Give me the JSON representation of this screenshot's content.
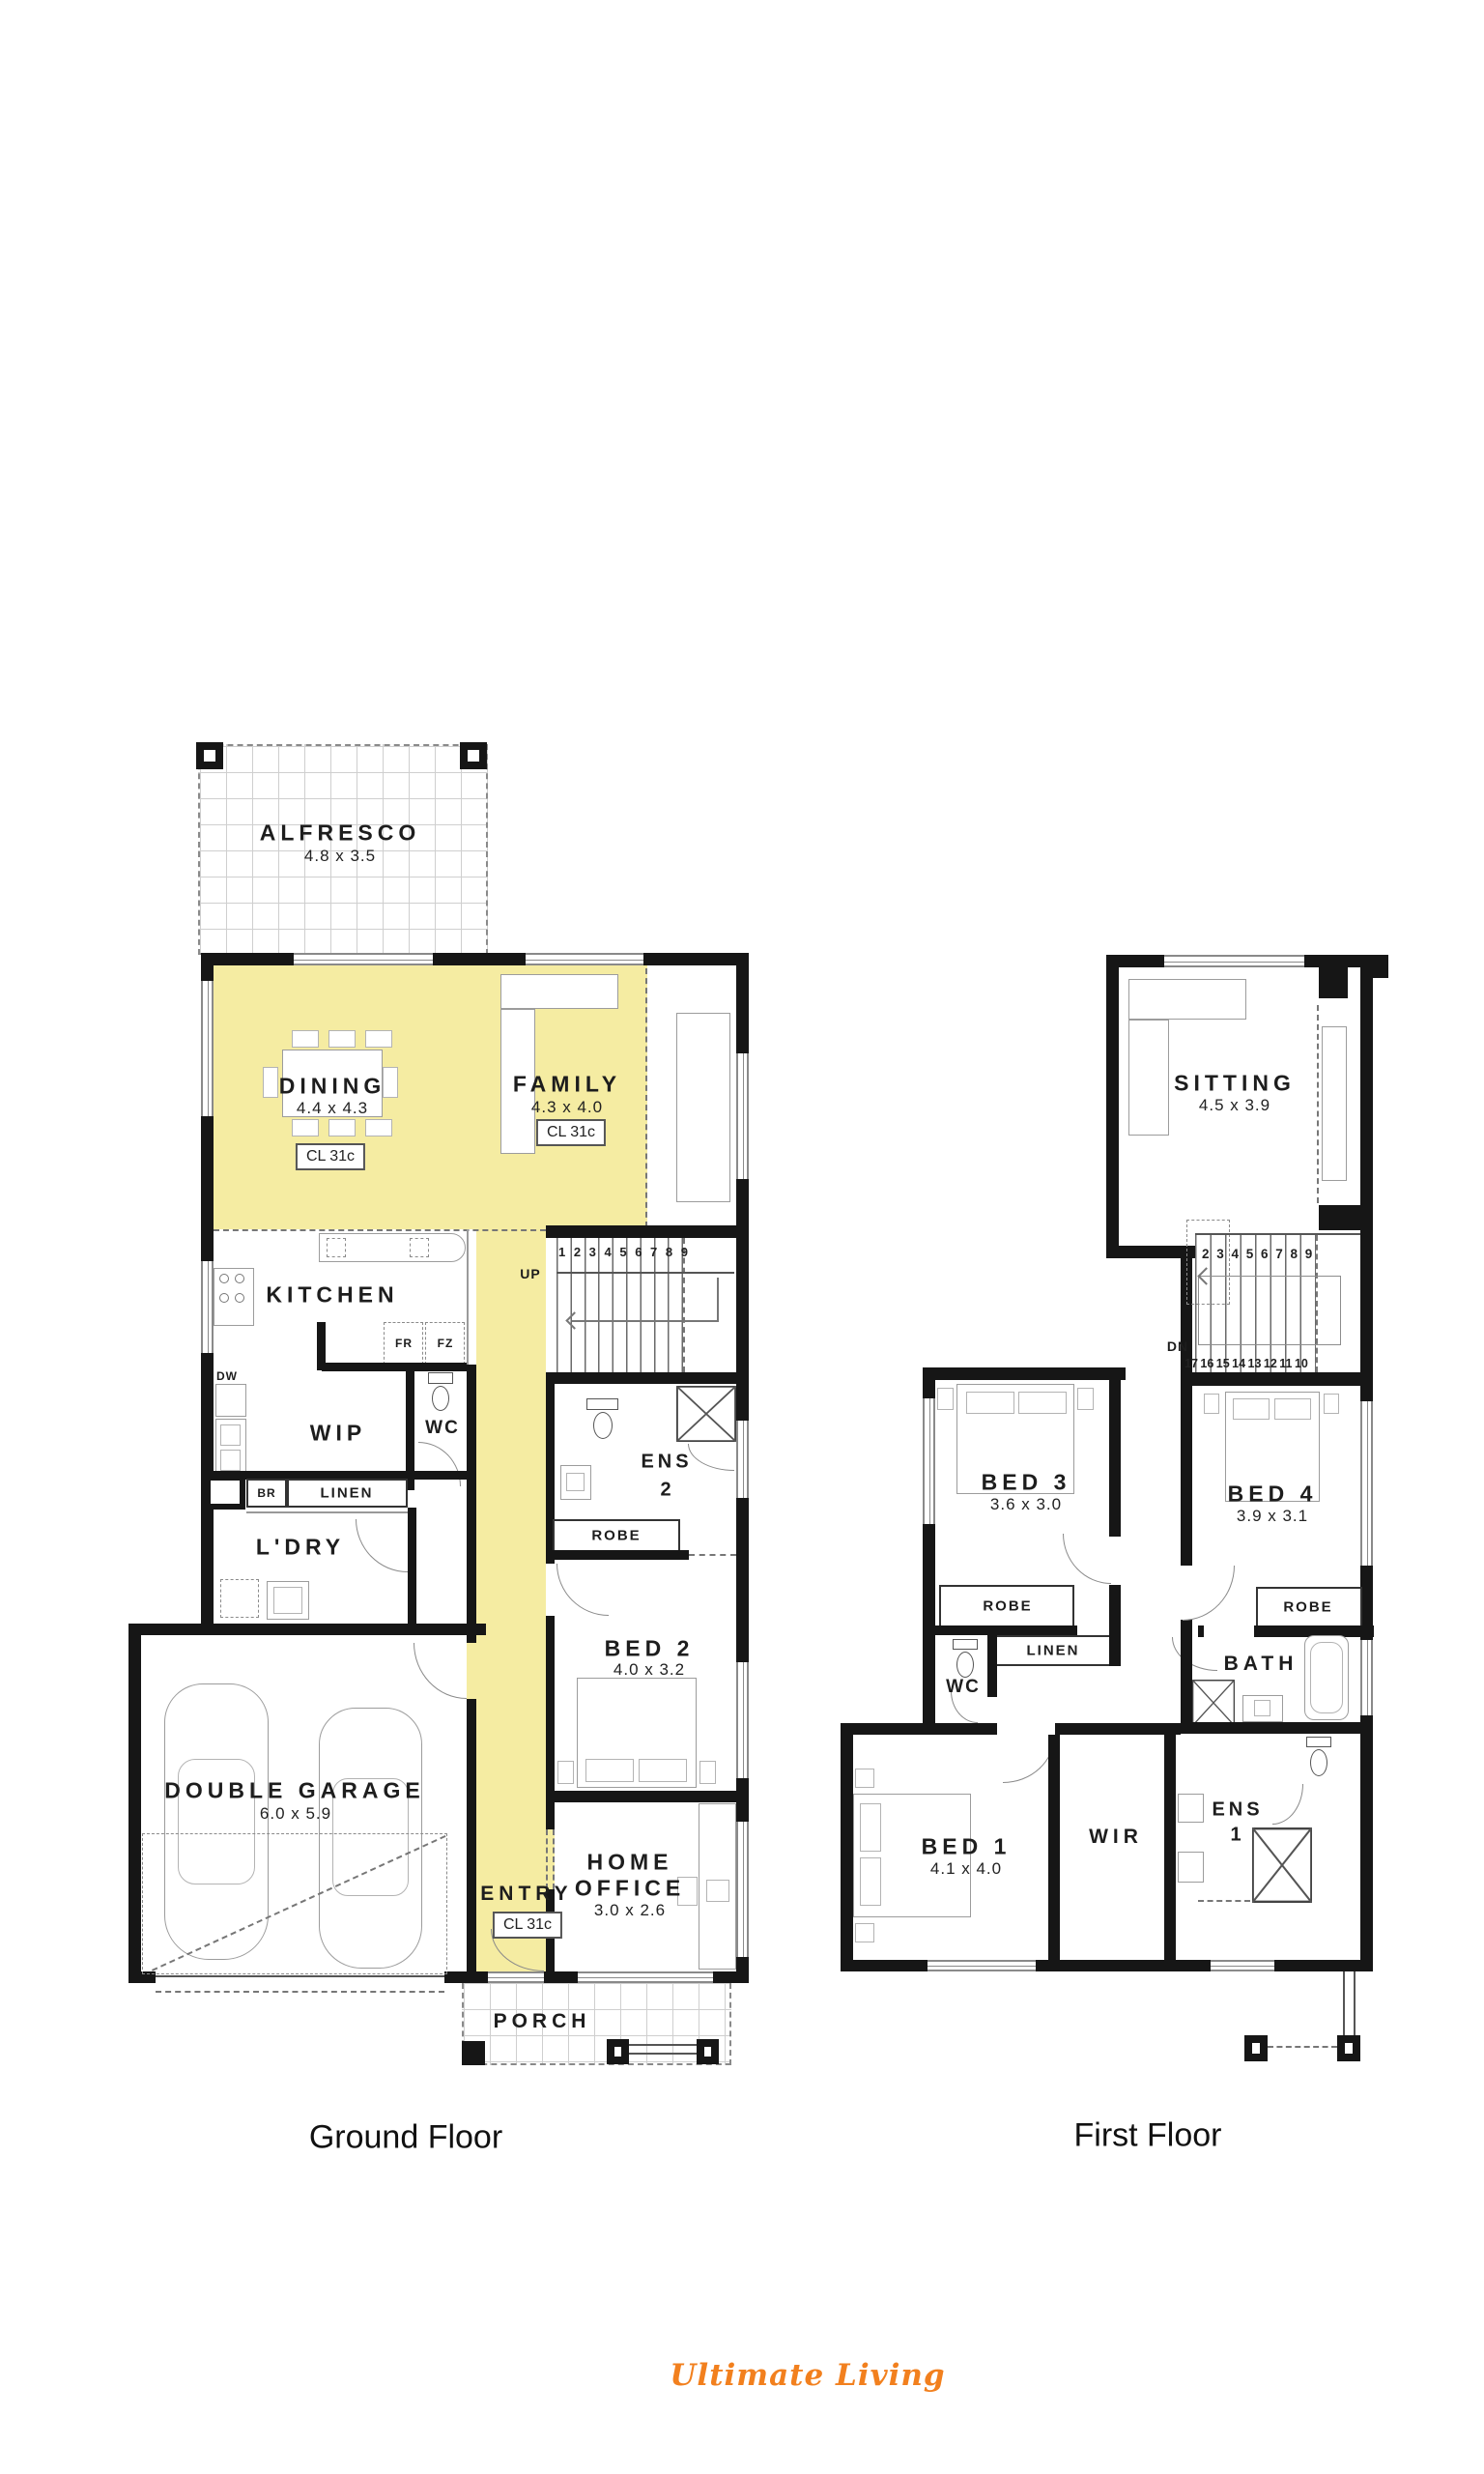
{
  "colors": {
    "highlight_yellow": "#F5ECA2",
    "wall_black": "#161616",
    "brand_orange": "#F2801E"
  },
  "titles": {
    "ground": "Ground Floor",
    "first": "First Floor"
  },
  "brand": {
    "name": "Ultimate Living"
  },
  "ground": {
    "alfresco": "ALFRESCO",
    "alfresco_dims": "4.8 x 3.5",
    "dining": "DINING",
    "dining_dims": "4.4 x 4.3",
    "dining_cl": "CL 31c",
    "family": "FAMILY",
    "family_dims": "4.3 x 4.0",
    "family_cl": "CL 31c",
    "kitchen": "KITCHEN",
    "fr": "FR",
    "fz": "FZ",
    "dw": "DW",
    "wip": "WIP",
    "wc": "WC",
    "up": "UP",
    "stair_numbers": "1 2 3 4 5 6 7 8 9",
    "ens2_1": "ENS",
    "ens2_2": "2",
    "robe": "ROBE",
    "br": "BR",
    "linen": "LINEN",
    "ldry": "L'DRY",
    "bed2": "BED 2",
    "bed2_dims": "4.0 x 3.2",
    "garage": "DOUBLE GARAGE",
    "garage_dims": "6.0 x 5.9",
    "entry": "ENTRY",
    "entry_cl": "CL 31c",
    "office_1": "HOME",
    "office_2": "OFFICE",
    "office_dims": "3.0 x 2.6",
    "porch": "PORCH"
  },
  "first": {
    "sitting": "SITTING",
    "sitting_dims": "4.5 x 3.9",
    "dn": "DN",
    "stair_numbers_top": "2 3 4 5 6 7 8 9",
    "stair_numbers_bottom": "17 16 15 14 13 12 11 10",
    "bed3": "BED 3",
    "bed3_dims": "3.6 x 3.0",
    "robe3": "ROBE",
    "linen": "LINEN",
    "wc": "WC",
    "bed4": "BED 4",
    "bed4_dims": "3.9 x 3.1",
    "robe4": "ROBE",
    "bath": "BATH",
    "bed1": "BED 1",
    "bed1_dims": "4.1 x 4.0",
    "wir": "WIR",
    "ens1_1": "ENS",
    "ens1_2": "1"
  }
}
